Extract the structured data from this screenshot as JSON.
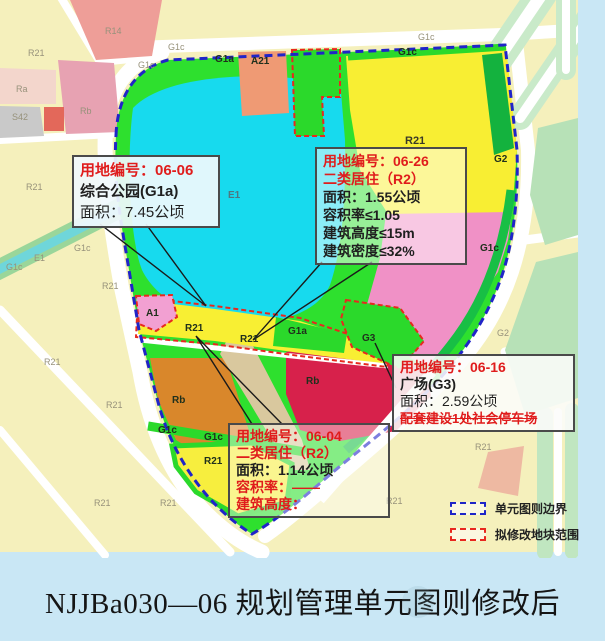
{
  "title": "NJJBa030—06 规划管理单元图则修改后",
  "legend": {
    "items": [
      {
        "label": "单元图则边界",
        "color": "#1f25c8",
        "style": "blue-dashed-rect"
      },
      {
        "label": "拟修改地块范围",
        "color": "#e8281e",
        "style": "red-dashed-rect"
      }
    ]
  },
  "annotation_boxes": [
    {
      "id": "06-06",
      "lines": [
        "用地编号：06-06",
        "综合公园(G1a)",
        "面积：7.45公顷"
      ]
    },
    {
      "id": "06-26",
      "lines": [
        "用地编号：06-26",
        "二类居住（R2）",
        "面积：1.55公顷",
        "容积率≤1.05",
        "建筑高度≤15m",
        "建筑密度≤32%"
      ]
    },
    {
      "id": "06-16",
      "lines": [
        "用地编号：06-16",
        "广场(G3)",
        "面积：2.59公顷",
        "配套建设1处社会停车场"
      ]
    },
    {
      "id": "06-04",
      "lines": [
        "用地编号：06-04",
        "二类居住（R2）",
        "面积：1.14公顷",
        "容积率：——",
        "建筑高度："
      ]
    }
  ],
  "map_labels": [
    {
      "t": "R21",
      "x": 28,
      "y": 48,
      "k": "out"
    },
    {
      "t": "R14",
      "x": 105,
      "y": 26,
      "k": "out"
    },
    {
      "t": "Ra",
      "x": 16,
      "y": 84,
      "k": "out"
    },
    {
      "t": "S42",
      "x": 12,
      "y": 112,
      "k": "out"
    },
    {
      "t": "Rb",
      "x": 80,
      "y": 106,
      "k": "out"
    },
    {
      "t": "G1c",
      "x": 138,
      "y": 60,
      "k": "out"
    },
    {
      "t": "G1c",
      "x": 168,
      "y": 42,
      "k": "out"
    },
    {
      "t": "R21",
      "x": 26,
      "y": 182,
      "k": "out"
    },
    {
      "t": "G1c",
      "x": 74,
      "y": 243,
      "k": "out"
    },
    {
      "t": "E1",
      "x": 34,
      "y": 253,
      "k": "out"
    },
    {
      "t": "G1c",
      "x": 6,
      "y": 262,
      "k": "out"
    },
    {
      "t": "R21",
      "x": 102,
      "y": 281,
      "k": "out"
    },
    {
      "t": "R21",
      "x": 44,
      "y": 357,
      "k": "out"
    },
    {
      "t": "R21",
      "x": 106,
      "y": 400,
      "k": "out"
    },
    {
      "t": "R21",
      "x": 94,
      "y": 498,
      "k": "out"
    },
    {
      "t": "R21",
      "x": 160,
      "y": 498,
      "k": "out"
    },
    {
      "t": "G1c",
      "x": 418,
      "y": 32,
      "k": "out"
    },
    {
      "t": "G2",
      "x": 497,
      "y": 328,
      "k": "out"
    },
    {
      "t": "R21",
      "x": 475,
      "y": 442,
      "k": "out"
    },
    {
      "t": "R21",
      "x": 386,
      "y": 496,
      "k": "out"
    },
    {
      "t": "G1c",
      "x": 398,
      "y": 47,
      "k": "in"
    },
    {
      "t": "R21",
      "x": 405,
      "y": 135,
      "k": "lg"
    },
    {
      "t": "G2",
      "x": 494,
      "y": 154,
      "k": "in"
    },
    {
      "t": "G1c",
      "x": 480,
      "y": 243,
      "k": "in"
    },
    {
      "t": "G1a",
      "x": 215,
      "y": 54,
      "k": "in"
    },
    {
      "t": "A21",
      "x": 251,
      "y": 56,
      "k": "in"
    },
    {
      "t": "E1",
      "x": 228,
      "y": 190,
      "k": "lake"
    },
    {
      "t": "A1",
      "x": 146,
      "y": 308,
      "k": "in"
    },
    {
      "t": "R21",
      "x": 185,
      "y": 323,
      "k": "in"
    },
    {
      "t": "R21",
      "x": 240,
      "y": 334,
      "k": "in"
    },
    {
      "t": "G1a",
      "x": 288,
      "y": 326,
      "k": "in"
    },
    {
      "t": "G3",
      "x": 362,
      "y": 333,
      "k": "in"
    },
    {
      "t": "Rb",
      "x": 172,
      "y": 395,
      "k": "in"
    },
    {
      "t": "Rb",
      "x": 306,
      "y": 376,
      "k": "in"
    },
    {
      "t": "R21",
      "x": 204,
      "y": 456,
      "k": "in"
    },
    {
      "t": "G1c",
      "x": 158,
      "y": 425,
      "k": "in"
    },
    {
      "t": "G1c",
      "x": 204,
      "y": 432,
      "k": "in"
    }
  ],
  "colors": {
    "background": "#c9e7f5",
    "unit_boundary": "#2024c8",
    "modified_parcel": "#e8281e",
    "lake": "#17daee",
    "park_green": "#2ee02e",
    "residential_yellow": "#f8ee33",
    "residential_pink": "#f091c6",
    "rb_orange": "#d9872b",
    "rb_crimson": "#d7214b",
    "code_red_text": "#e01c1c"
  }
}
